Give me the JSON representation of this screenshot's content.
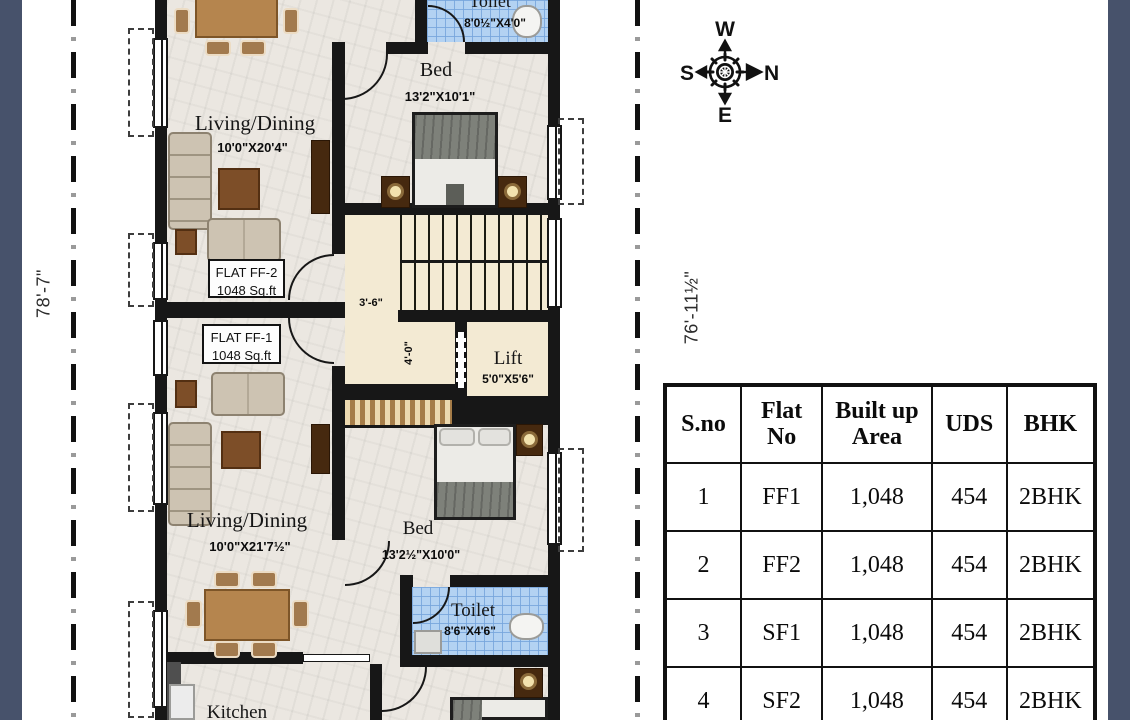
{
  "colors": {
    "side_band": "#47526b",
    "wall": "#171717",
    "toilet_tile": "#b3d2f2",
    "stair_floor": "#f3ead3"
  },
  "dimensions": {
    "left": "78'-7\"",
    "right": "76'-11½\""
  },
  "compass": {
    "top": "W",
    "right": "N",
    "bottom": "E",
    "left": "S"
  },
  "plan": {
    "ff2": {
      "flat_label": "FLAT FF-2",
      "flat_area": "1048 Sq.ft",
      "living": {
        "name": "Living/Dining",
        "size": "10'0\"X20'4\""
      },
      "bed": {
        "name": "Bed",
        "size": "13'2\"X10'1\""
      },
      "toilet": {
        "name": "Toilet",
        "size": "8'0½\"X4'0\""
      }
    },
    "ff1": {
      "flat_label": "FLAT FF-1",
      "flat_area": "1048 Sq.ft",
      "living": {
        "name": "Living/Dining",
        "size": "10'0\"X21'7½\""
      },
      "bed": {
        "name": "Bed",
        "size": "13'2½\"X10'0\""
      },
      "toilet": {
        "name": "Toilet",
        "size": "8'6\"X4'6\""
      },
      "kitchen": {
        "name": "Kitchen"
      }
    },
    "stair_width": "3'-6\"",
    "corridor_width": "4'-0\"",
    "lift": {
      "name": "Lift",
      "size": "5'0\"X5'6\""
    }
  },
  "table": {
    "headers": [
      "S.no",
      "Flat No",
      "Built up Area",
      "UDS",
      "BHK"
    ],
    "rows": [
      [
        "1",
        "FF1",
        "1,048",
        "454",
        "2BHK"
      ],
      [
        "2",
        "FF2",
        "1,048",
        "454",
        "2BHK"
      ],
      [
        "3",
        "SF1",
        "1,048",
        "454",
        "2BHK"
      ],
      [
        "4",
        "SF2",
        "1,048",
        "454",
        "2BHK"
      ]
    ]
  }
}
